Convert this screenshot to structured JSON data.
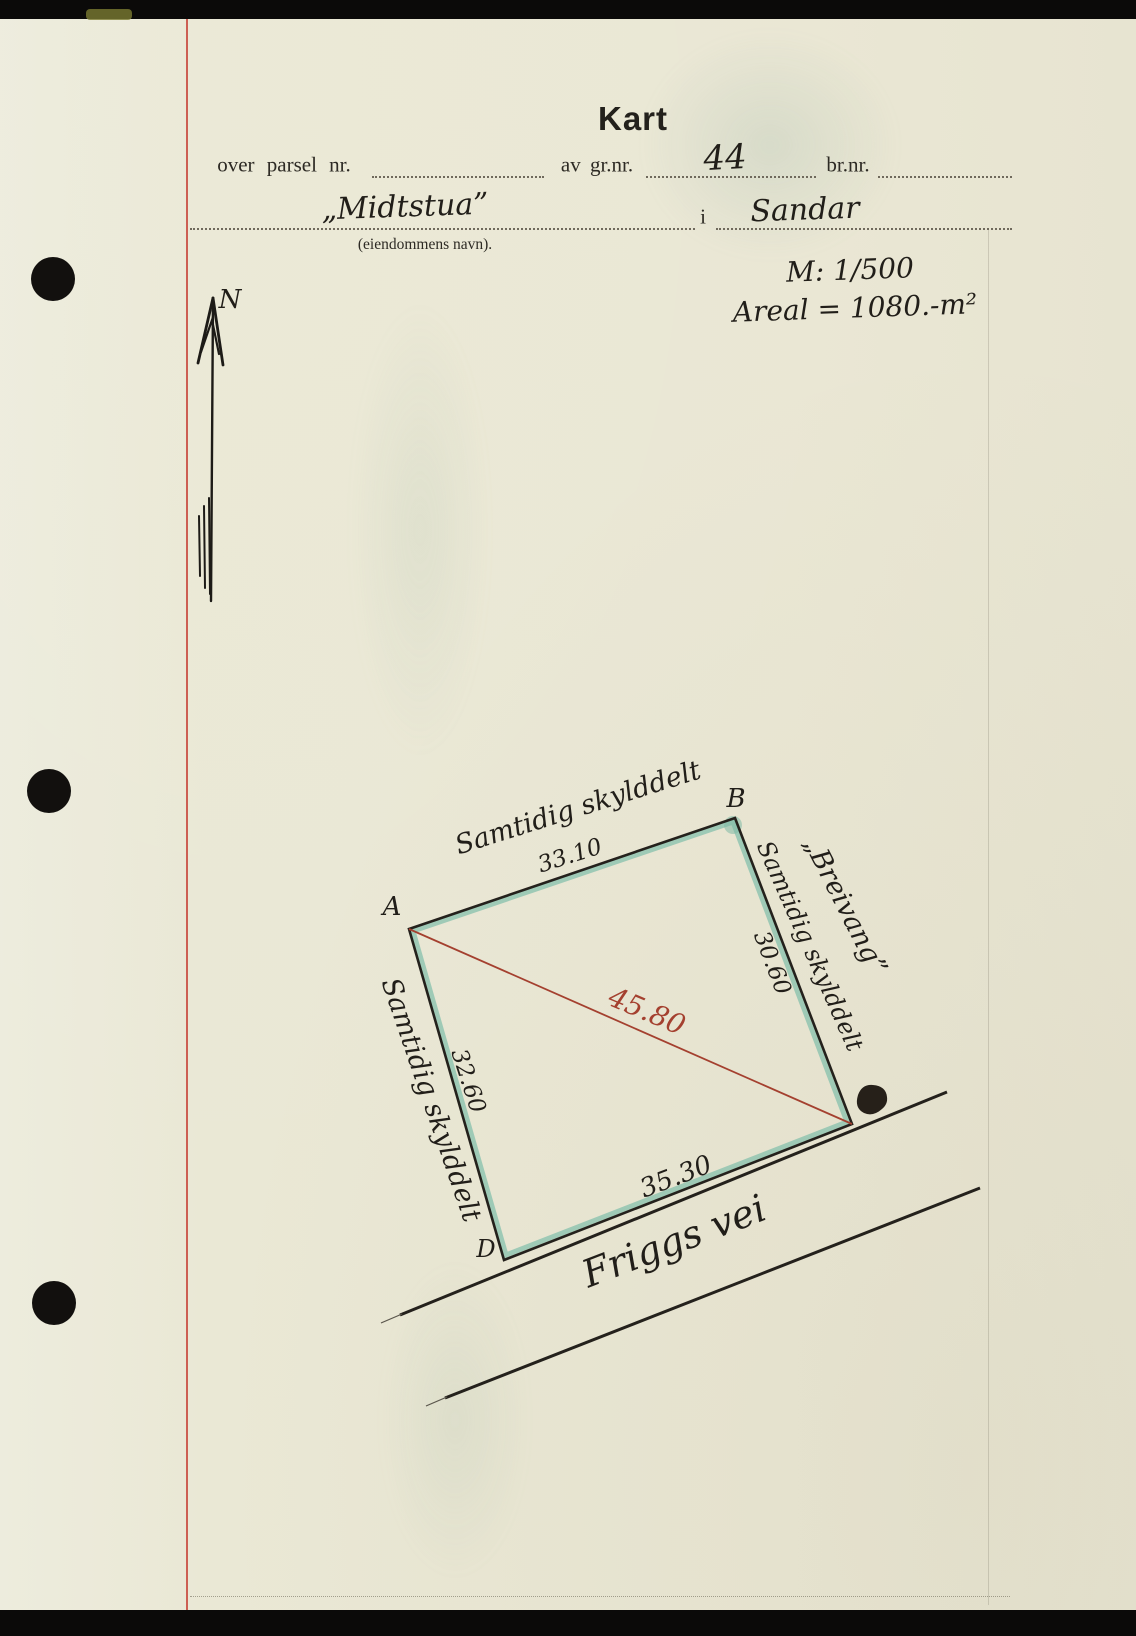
{
  "document": {
    "title": "Kart",
    "form": {
      "parcel_label": "over parsel nr.",
      "gnr_label": "av gr.nr.",
      "gnr_value": "44",
      "bnr_label": "br.nr.",
      "property_name": "„Midtstua”",
      "in_label": "i",
      "municipality": "Sandar",
      "property_name_caption": "(eiendommens navn).",
      "scale": "M: 1/500",
      "area": "Areal = 1080.-m²"
    },
    "compass": {
      "north_label": "N"
    },
    "map": {
      "corners": {
        "a": "A",
        "b": "B",
        "d": "D"
      },
      "sides": {
        "top": {
          "label": "Samtidig skylddelt",
          "length": "33.10"
        },
        "right": {
          "neighbor": "„Breivang”",
          "label": "Samtidig skylddelt",
          "length": "30.60"
        },
        "left": {
          "label": "Samtidig skylddelt",
          "length": "32.60"
        },
        "bottom": {
          "length": "35.30"
        }
      },
      "diagonal": {
        "length": "45.80"
      },
      "road": {
        "name": "Friggs vei"
      }
    },
    "colors": {
      "paper": "#eae7d5",
      "ink": "#23211c",
      "margin_red": "#c8473c",
      "diagonal_red": "#a4402f",
      "teal_highlight": "#85c0ac"
    }
  }
}
